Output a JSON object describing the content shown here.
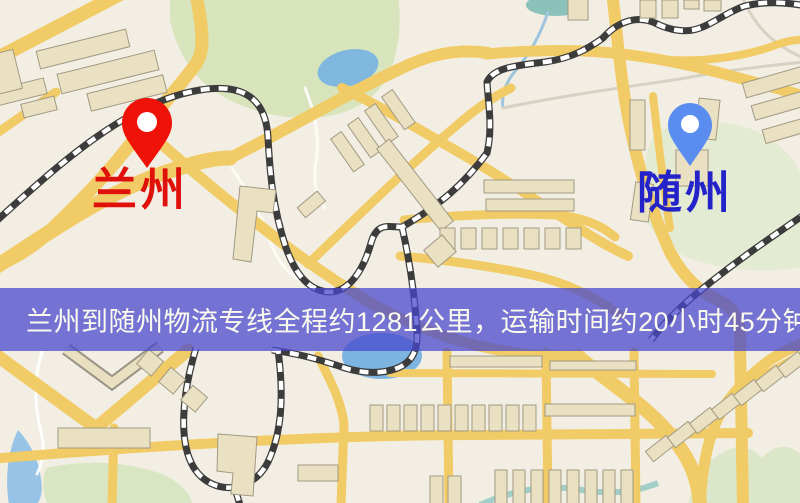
{
  "map": {
    "markers": [
      {
        "id": "origin",
        "label": "兰州",
        "label_color": "#e0100a",
        "pin_color": "#ee1208"
      },
      {
        "id": "destination",
        "label": "随州",
        "label_color": "#2423c9",
        "pin_color": "#5b8cf0"
      }
    ],
    "palette": {
      "base": "#f3eee3",
      "road_yellow": "#f1cb65",
      "park_green": "#d8e4bc",
      "water_blue": "#7fb7df",
      "railway_dark": "#3c3c3c",
      "building_tan": "#eae1c3"
    }
  },
  "banner": {
    "text": "兰州到随州物流专线全程约1281公里，运输时间约20小时45分钟.",
    "background_color": "#4848cd",
    "text_color": "#fbfaee"
  },
  "route": {
    "origin": "兰州",
    "destination": "随州",
    "distance_text": "约1281公里",
    "duration_text": "约20小时45分钟"
  }
}
